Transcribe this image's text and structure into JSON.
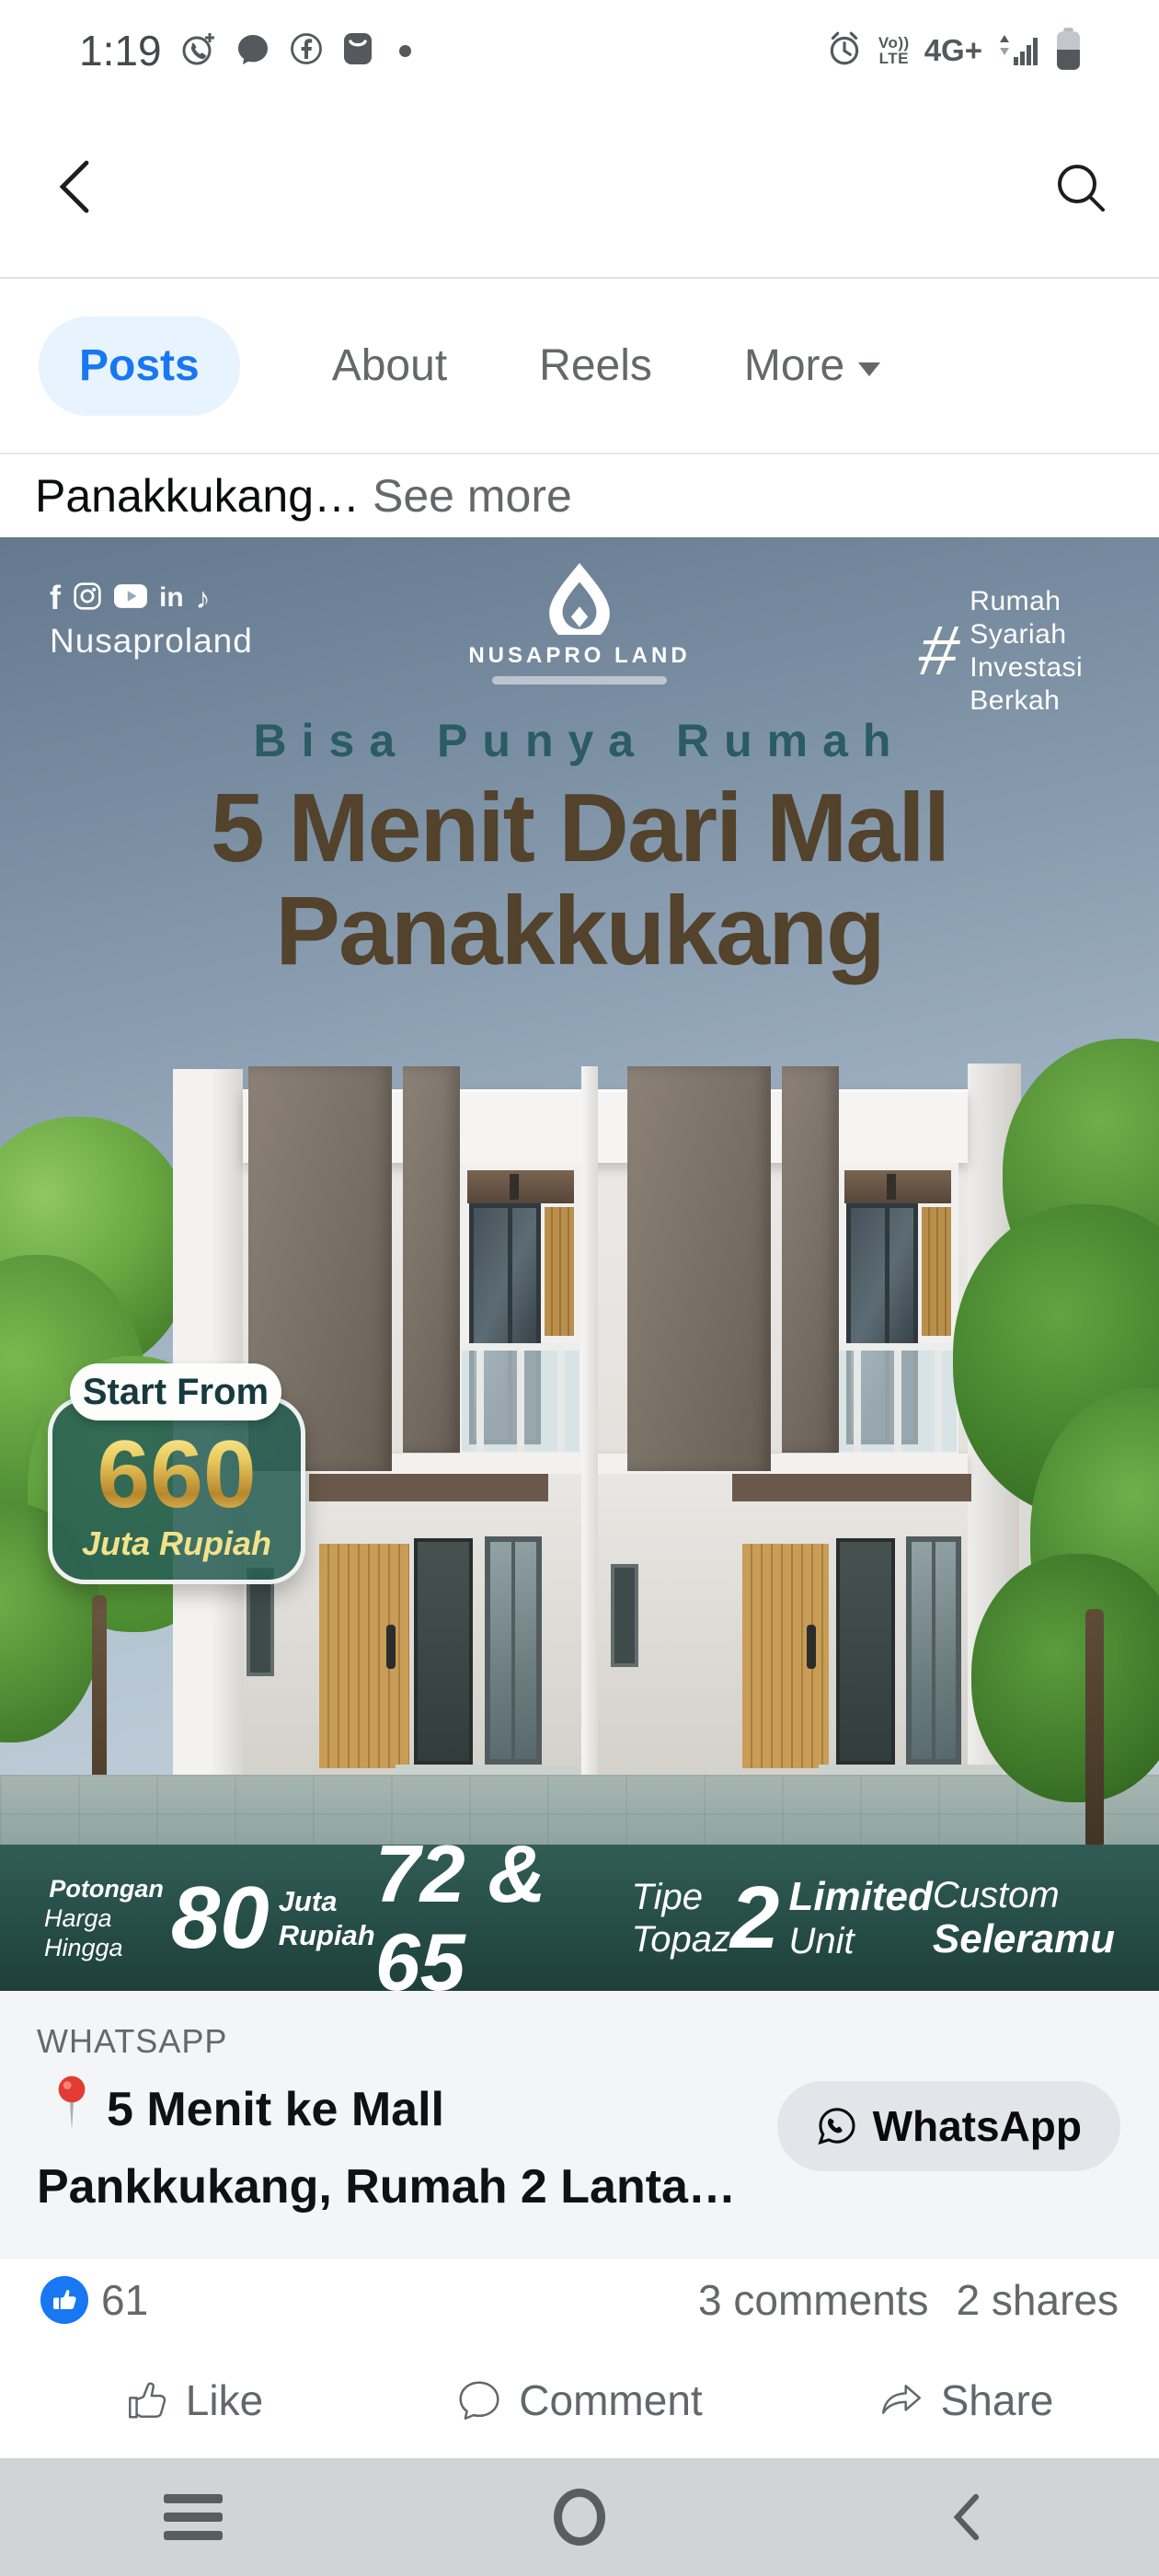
{
  "status_bar": {
    "time": "1:19",
    "volte_line1": "Vo))",
    "volte_line2": "LTE",
    "network": "4G+"
  },
  "profile_tabs": {
    "posts": "Posts",
    "about": "About",
    "reels": "Reels",
    "more": "More"
  },
  "post": {
    "truncated_text": "Panakkukang…",
    "see_more": "See more"
  },
  "ad": {
    "social_handle": "Nusaproland",
    "facebook_letter": "f",
    "linkedin_label": "in",
    "tiktok_glyph": "♪",
    "brand_name": "NUSAPRO LAND",
    "hashtag_symbol": "#",
    "hashtag_line1": "Rumah Syariah",
    "hashtag_line2": "Investasi Berkah",
    "tagline": "Bisa Punya Rumah",
    "headline_line1": "5 Menit Dari Mall",
    "headline_line2": "Panakkukang",
    "badge": {
      "label": "Start From",
      "value": "660",
      "unit": "Juta Rupiah"
    },
    "stats": {
      "discount": {
        "prefix_line1": "Potongan",
        "prefix_line2": "Harga Hingga",
        "value": "80",
        "unit_line1": "Juta",
        "unit_line2": "Rupiah"
      },
      "types": {
        "value": "72 & 65",
        "label_line1": "Tipe",
        "label_line2": "Topaz"
      },
      "units": {
        "value": "2",
        "label_line1": "Limited",
        "label_line2": "Unit"
      },
      "custom": {
        "line1": "Custom",
        "line2": "Seleramu"
      }
    }
  },
  "cta": {
    "source_label": "WHATSAPP",
    "title_line1": "5 Menit ke Mall",
    "title_line2": "Pankkukang, Rumah 2 Lanta…",
    "button_label": "WhatsApp"
  },
  "engagement": {
    "reaction_count": "61",
    "comments_label": "3 comments",
    "shares_label": "2 shares"
  },
  "action_bar": {
    "like": "Like",
    "comment": "Comment",
    "share": "Share"
  },
  "colors": {
    "facebook_blue": "#1877f2",
    "tab_pill_background": "#e7f3ff",
    "ad_teal": "#2d5a53",
    "headline_brown": "#53422c",
    "tagline_teal": "#2b5b63",
    "gold": "#e8c95c",
    "cta_background": "#f4f5f7",
    "button_gray": "#e2e5ea",
    "nav_bar_gray": "#d1d3d6"
  }
}
